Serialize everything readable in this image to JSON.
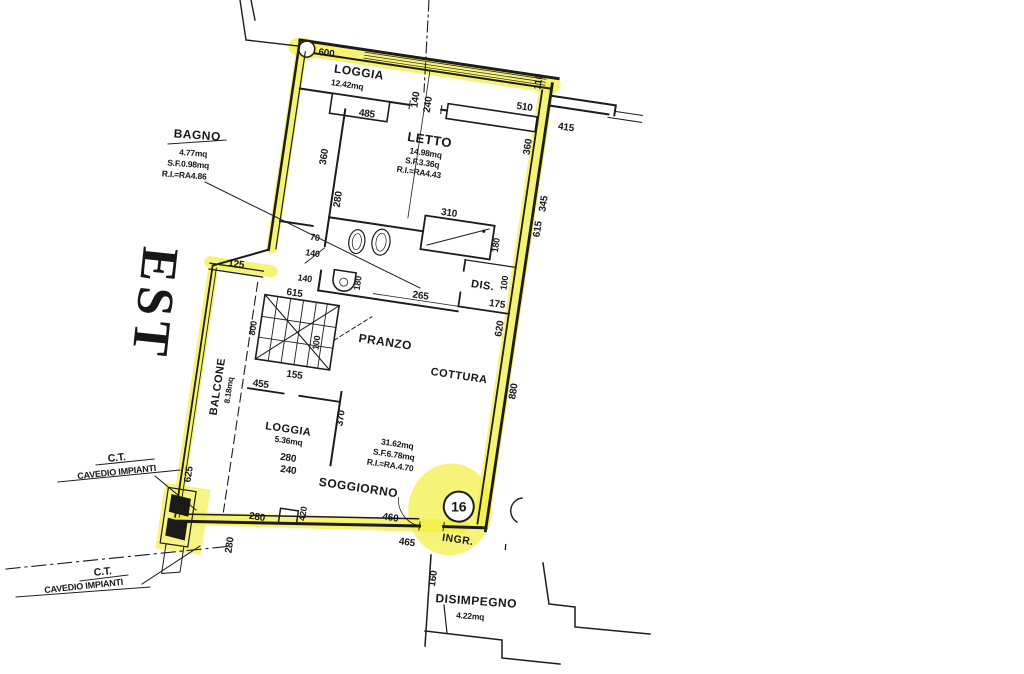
{
  "plan": {
    "orientation": "EST",
    "unit_badge": "16",
    "highlight_color": "#f3ee3f",
    "ink_color": "#1c1c1c",
    "rooms": {
      "loggia_top": {
        "name": "LOGGIA",
        "area": "12.42mq"
      },
      "letto": {
        "name": "LETTO",
        "area": "14.98mq",
        "sf": "S.F.3.36q",
        "ri": "R.I.=RA4.43"
      },
      "bagno": {
        "name": "BAGNO",
        "area": "4.77mq",
        "sf": "S.F.0.98mq",
        "ri": "R.I.=RA4.86"
      },
      "dis": {
        "name": "DIS."
      },
      "pranzo": {
        "name": "PRANZO"
      },
      "cottura": {
        "name": "COTTURA"
      },
      "loggia_mid": {
        "name": "LOGGIA",
        "area": "5.36mq"
      },
      "balcone": {
        "name": "BALCONE",
        "area": "8.18mq"
      },
      "soggiorno": {
        "name": "SOGGIORNO",
        "area": "31.62mq",
        "sf": "S.F.6.78mq",
        "ri": "R.I.=RA.4.70"
      },
      "ingresso": {
        "name": "INGR."
      },
      "disimpegno": {
        "name": "DISIMPEGNO",
        "area": "4.22mq"
      }
    },
    "ct_upper": {
      "line1": "C.T.",
      "line2": "CAVEDIO IMPIANTI"
    },
    "ct_lower": {
      "line1": "C.T.",
      "line2": "CAVEDIO IMPIANTI"
    },
    "stray_mark": "I",
    "dims": {
      "top_600": "600",
      "top_140": "140",
      "top_240": "240",
      "top_110": "110",
      "right_415": "415",
      "right_510": "510",
      "niche_485": "485",
      "letto_left_360": "360",
      "letto_right_360": "360",
      "right_345": "345",
      "right_615": "615",
      "letto_280": "280",
      "bath_70": "70",
      "bath_140a": "140",
      "bath_140b": "140",
      "shower_310": "310",
      "shower_180": "180",
      "wc_180": "180",
      "dis_100": "100",
      "dis_265": "265",
      "dis_175": "175",
      "right_620": "620",
      "right_880": "880",
      "stairs_615": "615",
      "stairs_800": "800",
      "stairs_100": "100",
      "stairs_155": "155",
      "loggia2_455": "455",
      "loggia2_370": "370",
      "loggia2_280": "280",
      "loggia2_240": "240",
      "balcone_125": "125",
      "balcone_625": "625",
      "bottom_280": "280",
      "bottom_420": "420",
      "bottom_460": "460",
      "bottom_465": "465",
      "bottomleft_280": "280",
      "disimp_160": "160"
    }
  }
}
